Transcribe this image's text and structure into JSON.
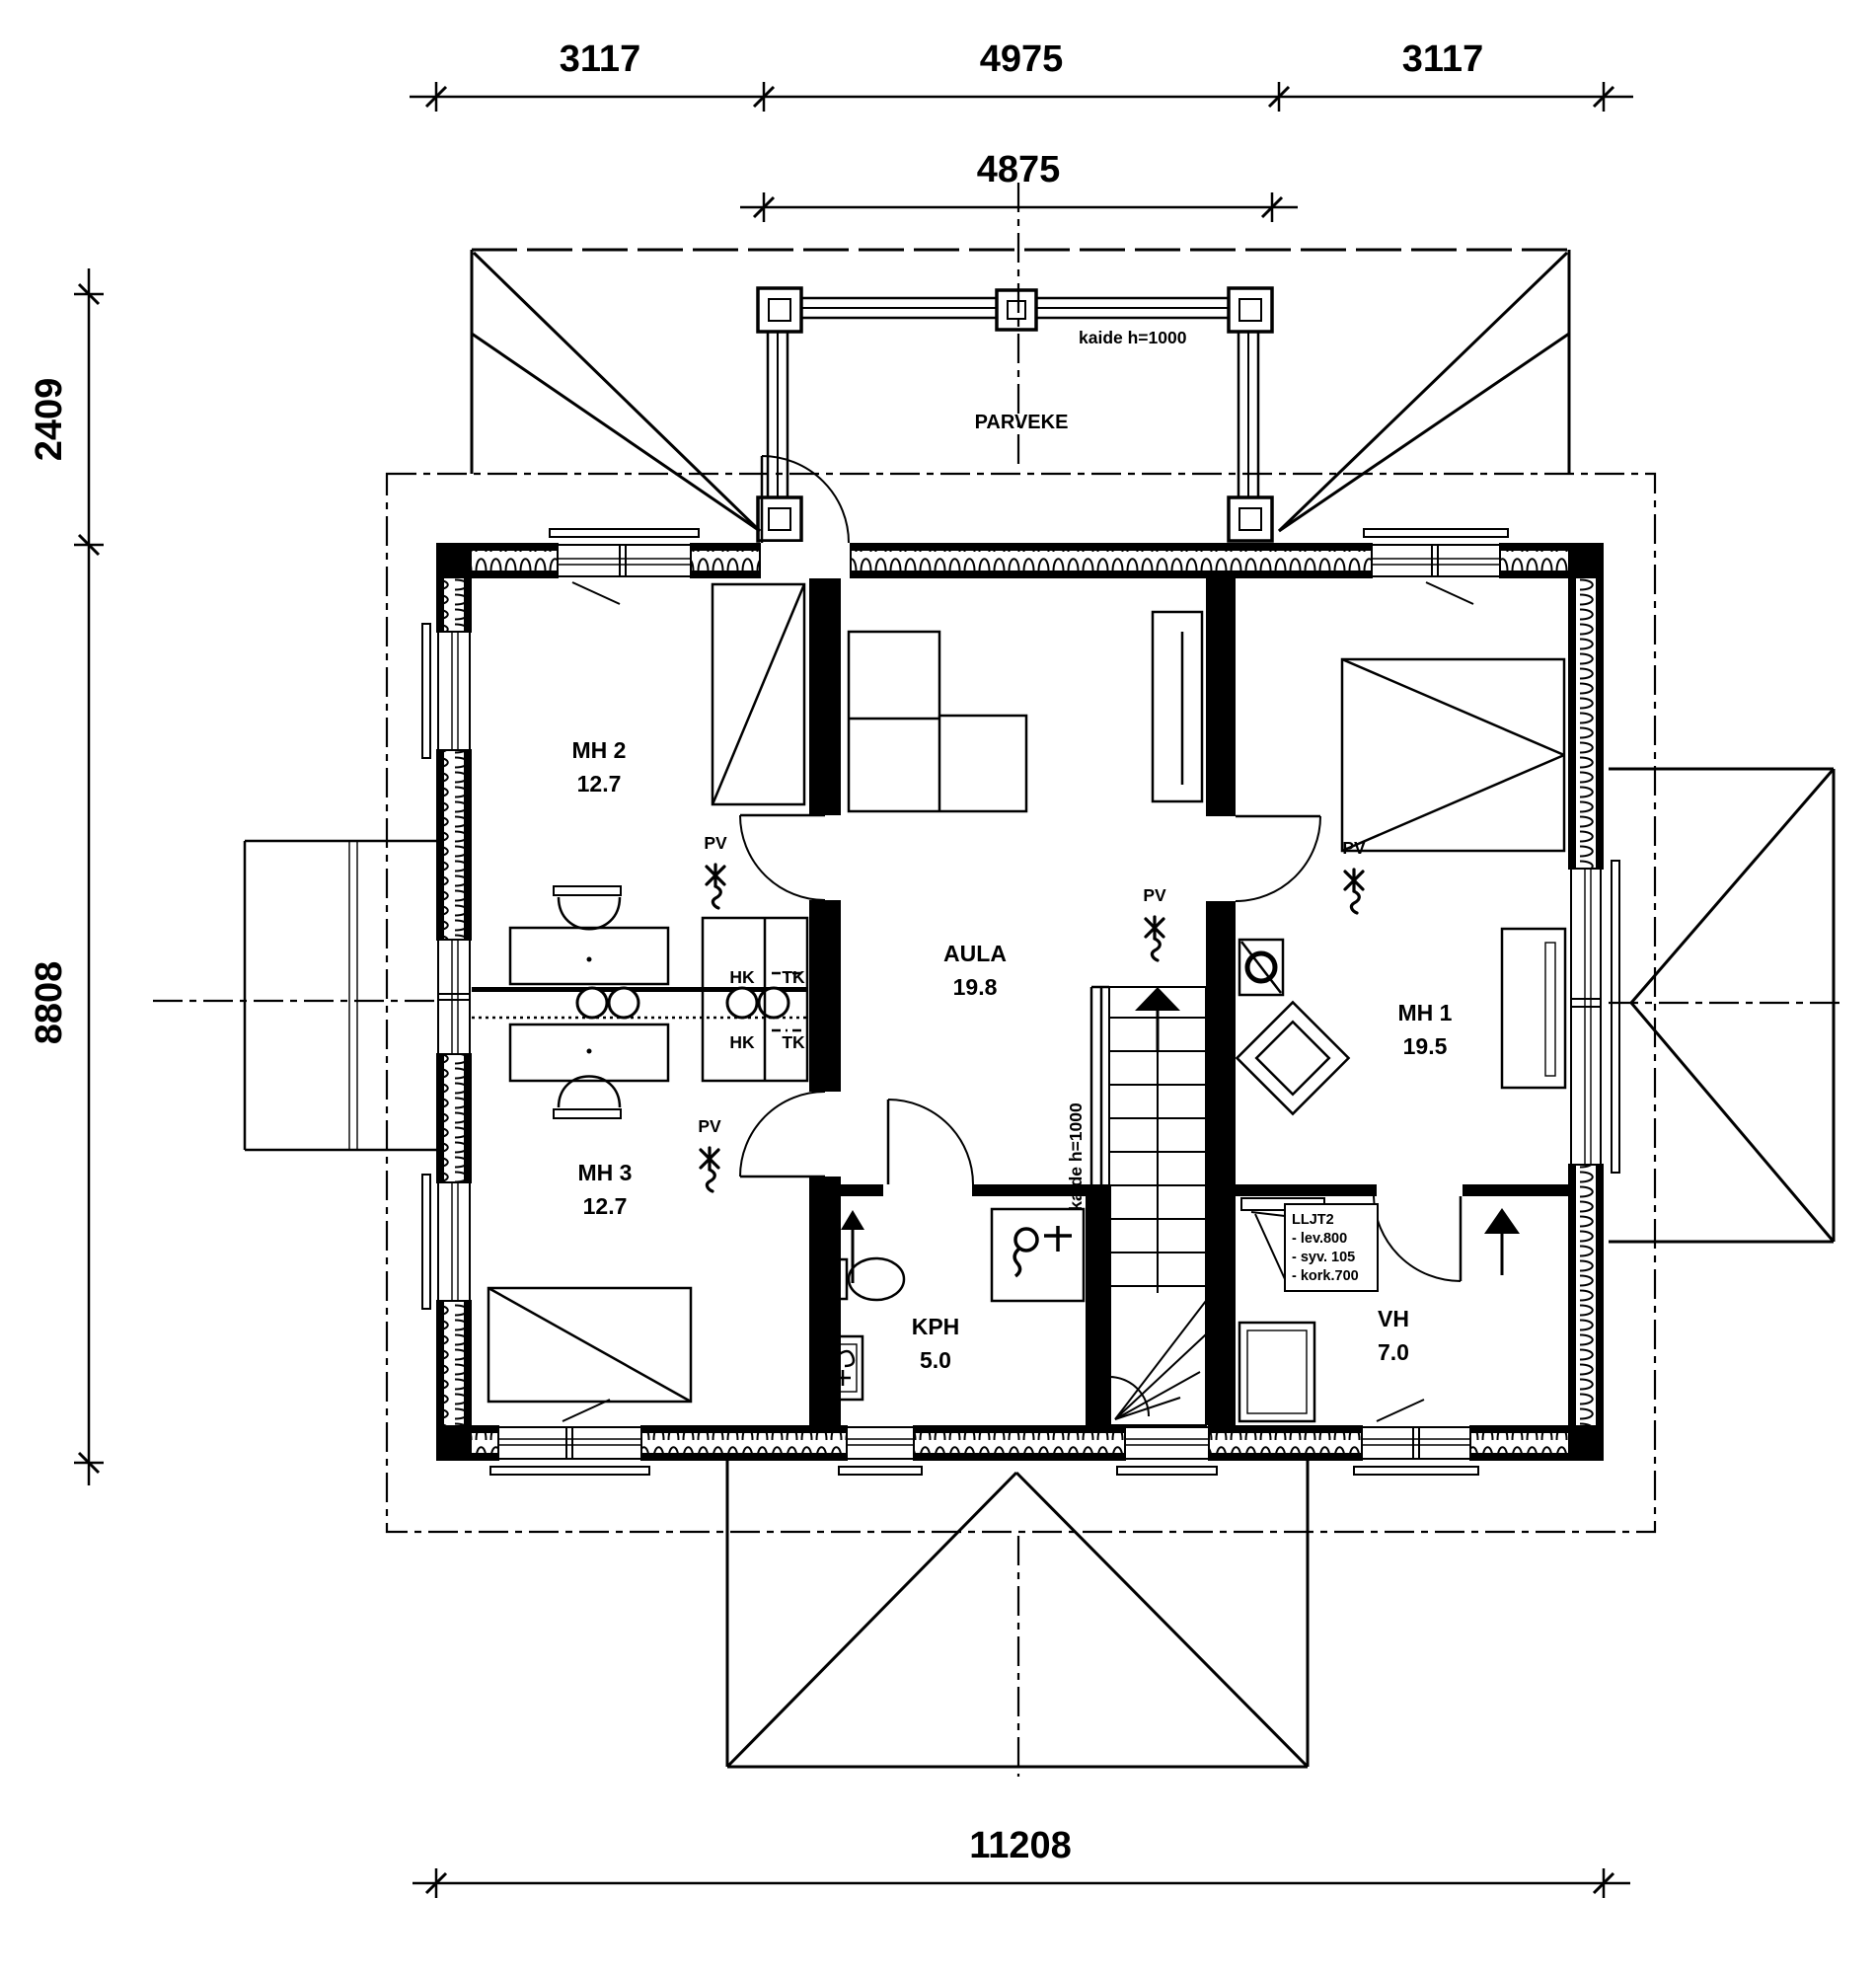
{
  "dims": {
    "top_left": "3117",
    "top_mid": "4975",
    "top_right": "3117",
    "balcony_width": "4875",
    "left_upper": "2409",
    "left_main": "8808",
    "bottom_total": "11208"
  },
  "rooms": {
    "parveke": {
      "name": "PARVEKE"
    },
    "mh2": {
      "name": "MH 2",
      "area": "12.7"
    },
    "mh3": {
      "name": "MH 3",
      "area": "12.7"
    },
    "aula": {
      "name": "AULA",
      "area": "19.8"
    },
    "mh1": {
      "name": "MH 1",
      "area": "19.5"
    },
    "kph": {
      "name": "KPH",
      "area": "5.0"
    },
    "vh": {
      "name": "VH",
      "area": "7.0"
    }
  },
  "labels": {
    "pv": "PV",
    "hk": "HK",
    "tk": "TK",
    "balcony_railing": "kaide h=1000",
    "stair_railing": "kaide h=1000"
  },
  "cabinet_note": {
    "title": "LLJT2",
    "line1": "- lev.800",
    "line2": "- syv. 105",
    "line3": "- kork.700"
  },
  "colors": {
    "ink": "#000000",
    "paper": "#ffffff"
  }
}
